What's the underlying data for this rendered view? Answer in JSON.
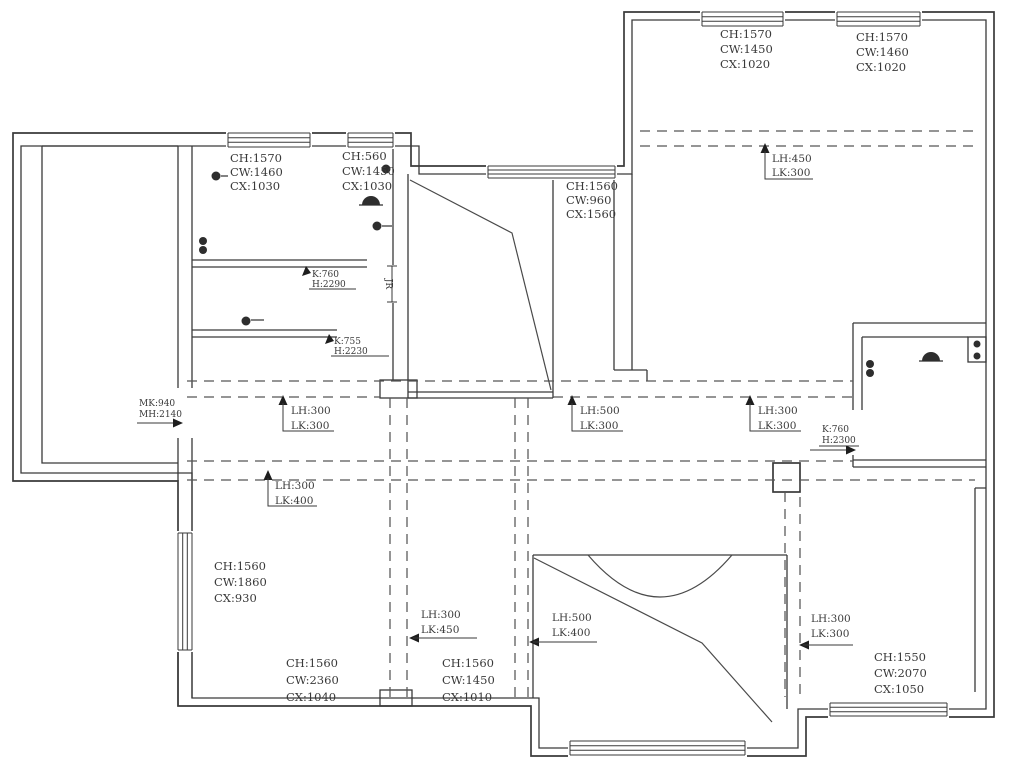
{
  "drawing": {
    "type": "floor-plan-ceiling-beam-layout",
    "colors": {
      "background": "#ffffff",
      "wall_line": "#3a3a3a",
      "dashed_beam_line": "#565656",
      "text": "#3a3a3a"
    }
  },
  "labels": {
    "tl_room": [
      "CH:1570",
      "CW:1460",
      "CX:1030"
    ],
    "tl_room2": [
      "CH:560",
      "CW:1450",
      "CX:1030"
    ],
    "stair_room": [
      "CH:1560",
      "CW:960",
      "CX:1560"
    ],
    "tr_room1": [
      "CH:1570",
      "CW:1450",
      "CX:1020"
    ],
    "tr_room2": [
      "CH:1570",
      "CW:1460",
      "CX:1020"
    ],
    "tr_beam": [
      "LH:450",
      "LK:300"
    ],
    "door_k1": [
      "K:760",
      "H:2290"
    ],
    "door_k2": [
      "K:755",
      "H:2230"
    ],
    "entry_door": [
      "MK:940",
      "MH:2140"
    ],
    "hall_beam_left": [
      "LH:300",
      "LK:300"
    ],
    "hall_beam_mid": [
      "LH:500",
      "LK:300"
    ],
    "hall_beam_right": [
      "LH:300",
      "LK:300"
    ],
    "kitchen_door": [
      "K:760",
      "H:2300"
    ],
    "hall_beam_lower": [
      "LH:300",
      "LK:400"
    ],
    "bl_room": [
      "CH:1560",
      "CW:1860",
      "CX:930"
    ],
    "beam_v_left": [
      "LH:300",
      "LK:450"
    ],
    "beam_bath": [
      "LH:500",
      "LK:400"
    ],
    "beam_br": [
      "LH:300",
      "LK:300"
    ],
    "bl_room_bottom": [
      "CH:1560",
      "CW:2360",
      "CX:1040"
    ],
    "bm_room_bottom": [
      "CH:1560",
      "CW:1450",
      "CX:1010"
    ],
    "br_room": [
      "CH:1550",
      "CW:2070",
      "CX:1050"
    ],
    "door_tag": "JR"
  }
}
